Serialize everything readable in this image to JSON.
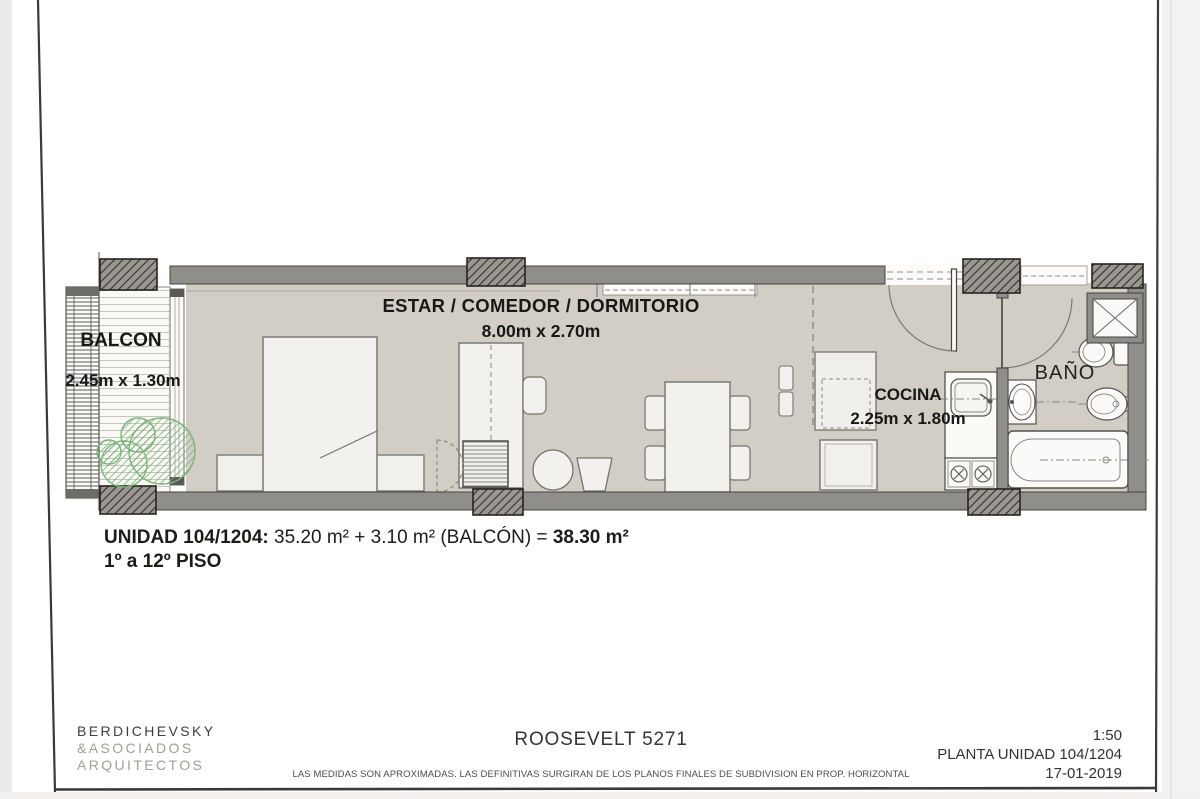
{
  "sheet": {
    "labels": {
      "living_name": "ESTAR / COMEDOR / DORMITORIO",
      "living_dims": "8.00m x 2.70m",
      "balcony_name": "BALCON",
      "balcony_dims": "2.45m x 1.30m",
      "kitchen_name": "COCINA",
      "kitchen_dims": "2.25m x 1.80m",
      "bathroom_name": "BAÑO"
    },
    "summary": {
      "unit_label": "UNIDAD 104/1204:",
      "unit_formula": "35.20 m² + 3.10 m² (BALCÓN) =",
      "unit_total": "38.30 m²",
      "floors": "1º a 12º PISO"
    },
    "titleblock": {
      "firm_line1": "BERDICHEVSKY",
      "firm_line2": "&ASOCIADOS",
      "firm_line3": "ARQUITECTOS",
      "project": "ROOSEVELT 5271",
      "disclaimer": "LAS MEDIDAS SON APROXIMADAS. LAS DEFINITIVAS SURGIRAN DE LOS PLANOS FINALES DE SUBDIVISION EN PROP. HORIZONTAL",
      "scale": "1:50",
      "sheet_name": "PLANTA UNIDAD 104/1204",
      "date": "17-01-2019"
    },
    "colors": {
      "floor": "#d2cec5",
      "wall": "#908e8a",
      "plant": "#74b074",
      "ink": "#1f1f1d"
    }
  }
}
